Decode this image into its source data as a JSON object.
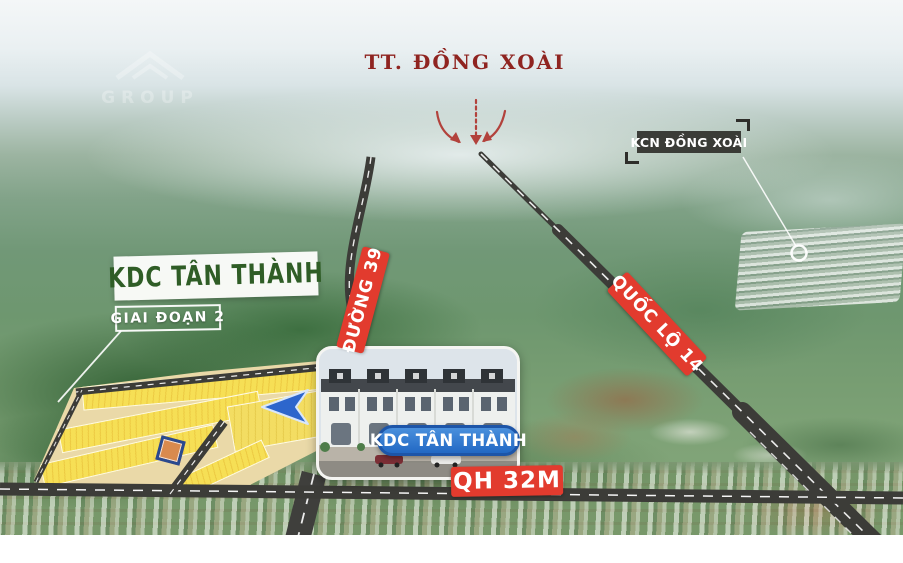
{
  "watermark": {
    "text": "GROUP"
  },
  "header": {
    "destination_label": "TT. ĐỒNG XOÀI"
  },
  "labels": {
    "industrial_zone": "KCN ĐỒNG XOÀI",
    "project_title": "KDC TÂN THÀNH",
    "project_phase": "GIAI ĐOẠN 2",
    "road_duong39": "ĐƯỜNG 39",
    "road_quoc_lo_14": "QUỐC LỘ 14",
    "road_qh_32m": "QH 32M",
    "building_label": "KDC TÂN THÀNH"
  },
  "colors": {
    "maroon_text": "#8f2420",
    "road_label_red": "#e23b2e",
    "project_green": "#2f5d26",
    "pill_blue": "#2268c4",
    "kcn_box_dark": "#30302c",
    "plot_yellow": "#f6df55",
    "direction_arrow_blue": "#2d66cc",
    "road_dark": "#3c3c38"
  }
}
